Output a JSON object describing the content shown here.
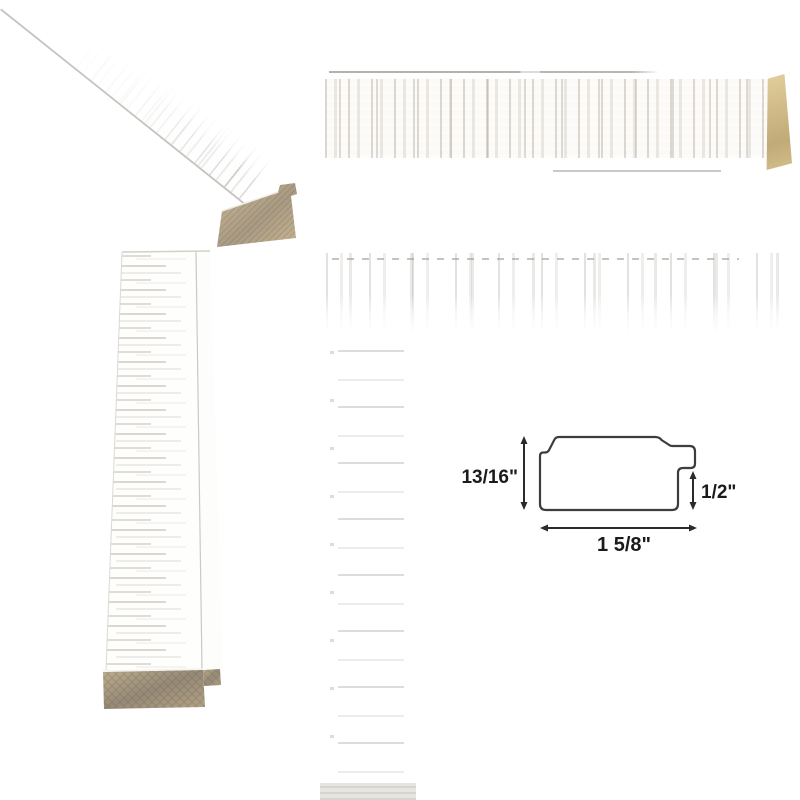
{
  "page": {
    "background": "#ffffff"
  },
  "views": {
    "diagonal": "moulding-corner-diagonal-view",
    "horizontal": "moulding-front-horizontal-view",
    "vertical": "moulding-front-vertical-view",
    "detail": "moulding-washed-texture-corner-detail"
  },
  "colors": {
    "background": "#ffffff",
    "whitewash_streak": "#d8d3cb",
    "whitewash_streak_dark": "#c2bbae",
    "raw_wood_light": "#cdbb97",
    "raw_wood_dark": "#a2947f",
    "edge_line_gray": "#b4b2ad",
    "diagram_line": "#3d3d3d",
    "diagram_text": "#1b1b1b"
  },
  "dimension_diagram": {
    "height_label": "13/16\"",
    "rabbet_height_label": "1/2\"",
    "width_label": "1 5/8\""
  }
}
